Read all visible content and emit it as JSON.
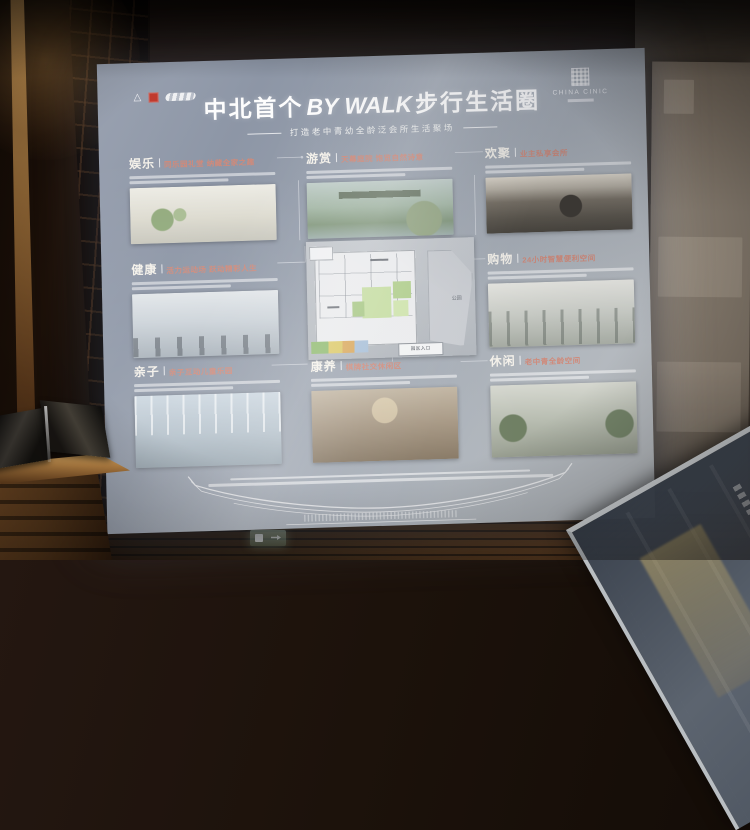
{
  "board": {
    "logos": {
      "left": [
        "hillside-mark-logo",
        "red-seal-logo",
        "script-wordmark-logo"
      ],
      "left_mark_glyph": "△",
      "right_wordmark": "CHINA CINIC"
    },
    "title": {
      "prefix": "中北首个",
      "en": "BY WALK",
      "suffix": "步行生活圈"
    },
    "subtitle": "打造老中青幼全龄泛会所生活聚场",
    "sections": [
      {
        "name": "娱乐",
        "subtitle": "同乐园礼堂 纳藏全家之趣"
      },
      {
        "name": "游赏",
        "subtitle": "天幕庭院 饱览自然诗意"
      },
      {
        "name": "欢聚",
        "subtitle": "业主私享会所"
      },
      {
        "name": "健康",
        "subtitle": "活力运动场 跃动精彩人生"
      },
      {
        "name": "购物",
        "subtitle": "24小时智慧便利空间"
      },
      {
        "name": "亲子",
        "subtitle": "亲子互动儿童乐园"
      },
      {
        "name": "康养",
        "subtitle": "棋牌社交休闲区"
      },
      {
        "name": "休闲",
        "subtitle": "老中青全龄空间"
      }
    ],
    "map": {
      "entrance_label": "园区入口",
      "park_label": "公园"
    },
    "colors": {
      "board_top": "#8d96a6",
      "board_bottom": "#bcc0c4",
      "section_accent": "#d08a7a",
      "seal_red": "#c03a2e",
      "map_green": "#c6dda3"
    }
  }
}
